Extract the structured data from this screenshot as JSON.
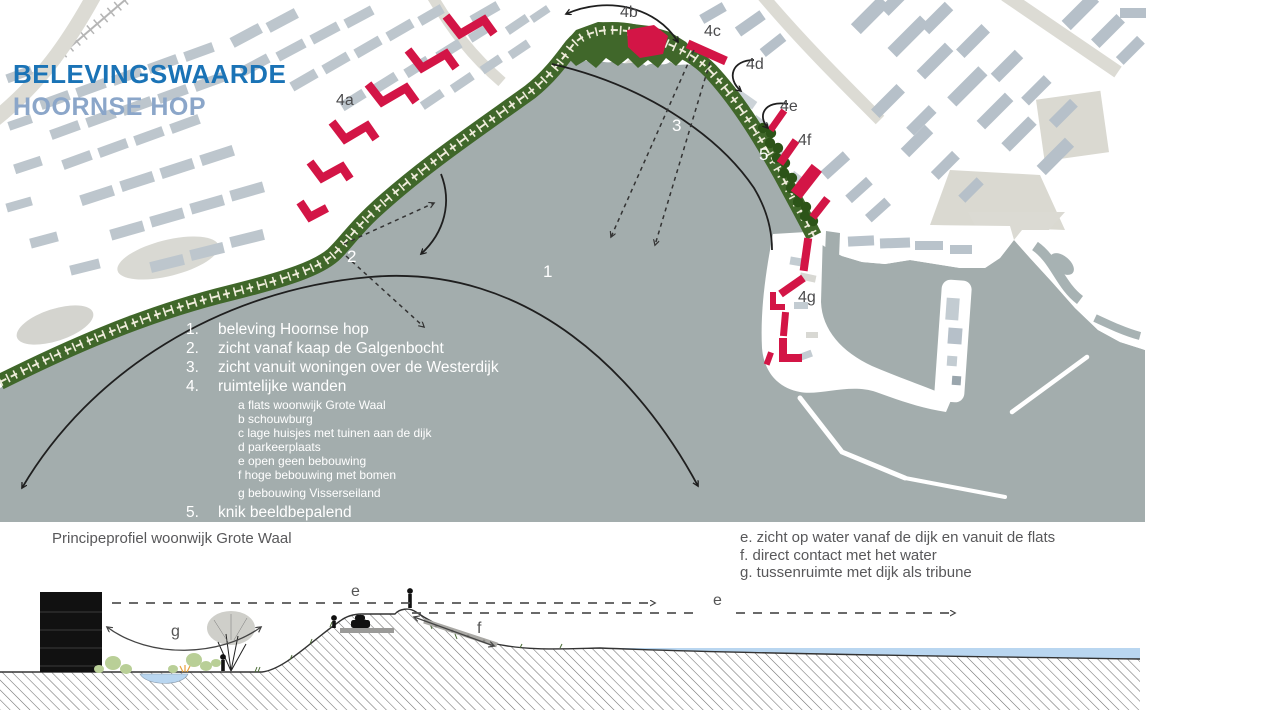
{
  "title": {
    "line1": "BELEVINGSWAARDE",
    "line2": "HOORNSE HOP"
  },
  "map": {
    "labels": {
      "n1": "1",
      "n2": "2",
      "n3": "3",
      "n5": "5",
      "a4a": "4a",
      "a4b": "4b",
      "a4c": "4c",
      "a4d": "4d",
      "a4e": "4e",
      "a4f": "4f",
      "a4g": "4g"
    },
    "legend": {
      "items": [
        {
          "num": "1.",
          "text": "beleving Hoornse hop"
        },
        {
          "num": "2.",
          "text": "zicht vanaf kaap de Galgenbocht"
        },
        {
          "num": "3.",
          "text": "zicht vanuit woningen over de Westerdijk"
        },
        {
          "num": "4.",
          "text": "ruimtelijke wanden"
        },
        {
          "num": "5.",
          "text": "knik beeldbepalend"
        }
      ],
      "subitems": [
        "a flats woonwijk Grote Waal",
        "b schouwburg",
        "c lage huisjes met tuinen aan de dijk",
        "d parkeerplaats",
        "e open geen bebouwing",
        "f hoge bebouwing met bomen",
        "g bebouwing Visserseiland"
      ]
    }
  },
  "section": {
    "caption": "Principeprofiel woonwijk Grote Waal",
    "notes": [
      "e. zicht op water vanaf de dijk en vanuit de flats",
      "f. direct contact met het water",
      "g. tussenruimte met dijk als tribune"
    ],
    "labels": {
      "e1": "e",
      "e2": "e",
      "f": "f",
      "g": "g"
    }
  },
  "colors": {
    "title_blue": "#1a73b6",
    "subtitle_blue": "#8ba6c9",
    "water_gray": "#a3adad",
    "dike_green": "#40672a",
    "tree_green": "#2c5418",
    "building_red": "#d31546",
    "city_block": "#b9c3cb",
    "beige_road": "#dcdbd4",
    "section_water": "#b9d6f0"
  }
}
